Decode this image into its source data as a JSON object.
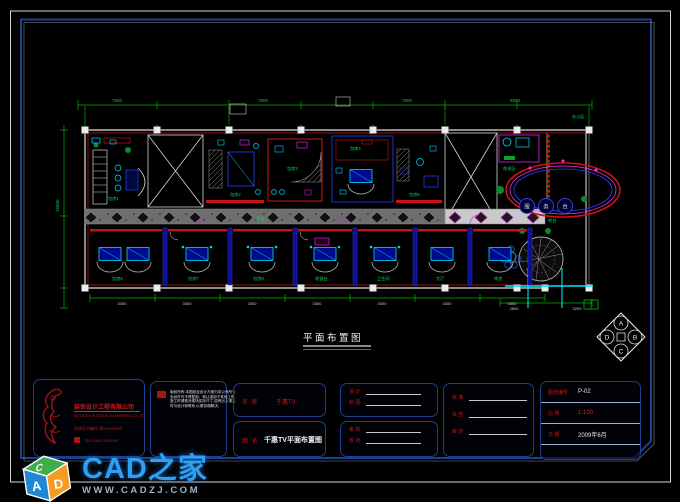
{
  "logo": {
    "brand": "CAD之家",
    "url": "WWW.CADZJ.COM",
    "cube": {
      "top": "C",
      "left": "A",
      "right": "D"
    }
  },
  "plan": {
    "title": "平面布置图",
    "compass": {
      "top": "A",
      "right": "B",
      "bottom": "C",
      "left": "D"
    },
    "dims_top": [
      "7500",
      "7500",
      "7500",
      "6600"
    ],
    "dims_bottom": [
      "3300",
      "3300",
      "3300",
      "3300",
      "3300",
      "3300",
      "3300"
    ],
    "dims_left": "15600",
    "dims_right": [
      "2600",
      "3200"
    ],
    "labels": [
      "包房1",
      "包房2",
      "包房3",
      "包房4",
      "包房5",
      "包房6",
      "包房7",
      "包房8",
      "走道",
      "收银台",
      "吧台",
      "办公区",
      "卫生间",
      "大厅",
      "库房",
      "休息区"
    ],
    "ellipse_chars": [
      "服",
      "务",
      "台"
    ]
  },
  "titleblock": {
    "company": {
      "name": "装饰设计工程有限公司",
      "name_en": "DECORATION DESIGN ENGINEERING CO.,LTD",
      "cert": "资质证书编号 第0000000号",
      "tel": "TEL 0000-0000000"
    },
    "notes": [
      "版权所有:本图纸及设计方案归本公司所有,",
      "未经许可不得复制、转让或用于其他工程。",
      "施工时请核对现场实际尺寸,如有出入请及",
      "时与设计师联系,以便协调解决。"
    ],
    "project_label": "名 称",
    "project_value": "千惠TV",
    "drawing_label": "图 名",
    "drawing_value": "千惠TV平面布置图",
    "sign_a": [
      "设 计",
      "制 图"
    ],
    "sign_b": [
      "审 核",
      "校 对"
    ],
    "sign_c": [
      "批 准",
      "会 签",
      "审 定"
    ],
    "info": [
      {
        "label": "图纸编号",
        "value": "P-02"
      },
      {
        "label": "比 例",
        "value": "1:100"
      },
      {
        "label": "日 期",
        "value": "2009年6月"
      }
    ]
  }
}
